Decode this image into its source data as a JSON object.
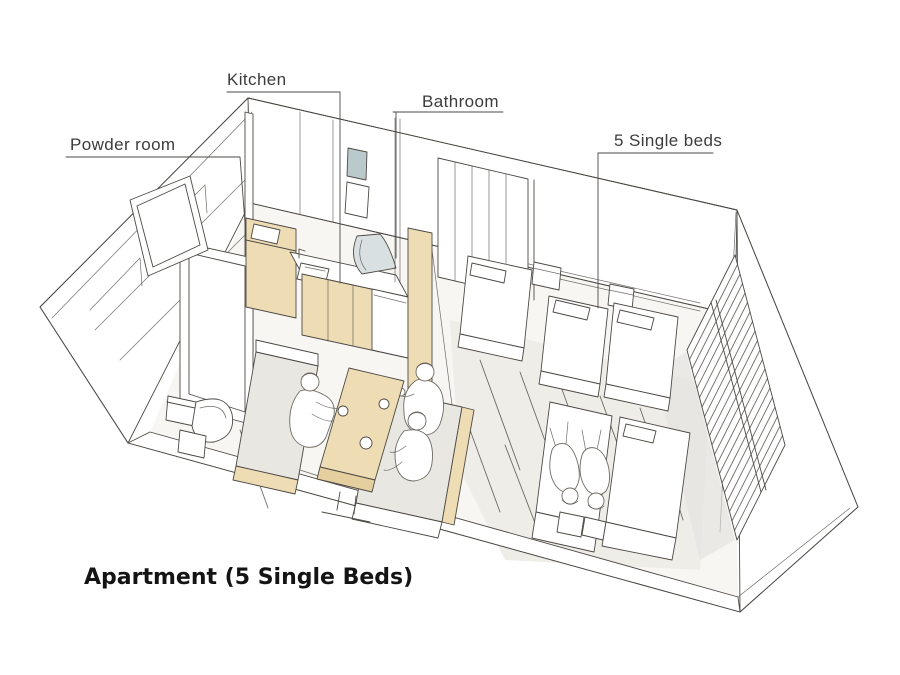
{
  "figure": {
    "caption": "Apartment (5 Single Beds)",
    "annotations": {
      "powder_room": "Powder room",
      "kitchen": "Kitchen",
      "bathroom": "Bathroom",
      "beds": "5 Single beds"
    },
    "colors": {
      "sketch_line": "#4d4a45",
      "wood": "#eedcb4",
      "wood_dark": "#e5cf9f",
      "glass_blue": "#bac9cc",
      "floor": "#f7f6f2",
      "cushion_gray": "#e9e7e2",
      "label_text": "#3c3c3c",
      "caption_text": "#141414",
      "background": "#ffffff"
    }
  }
}
